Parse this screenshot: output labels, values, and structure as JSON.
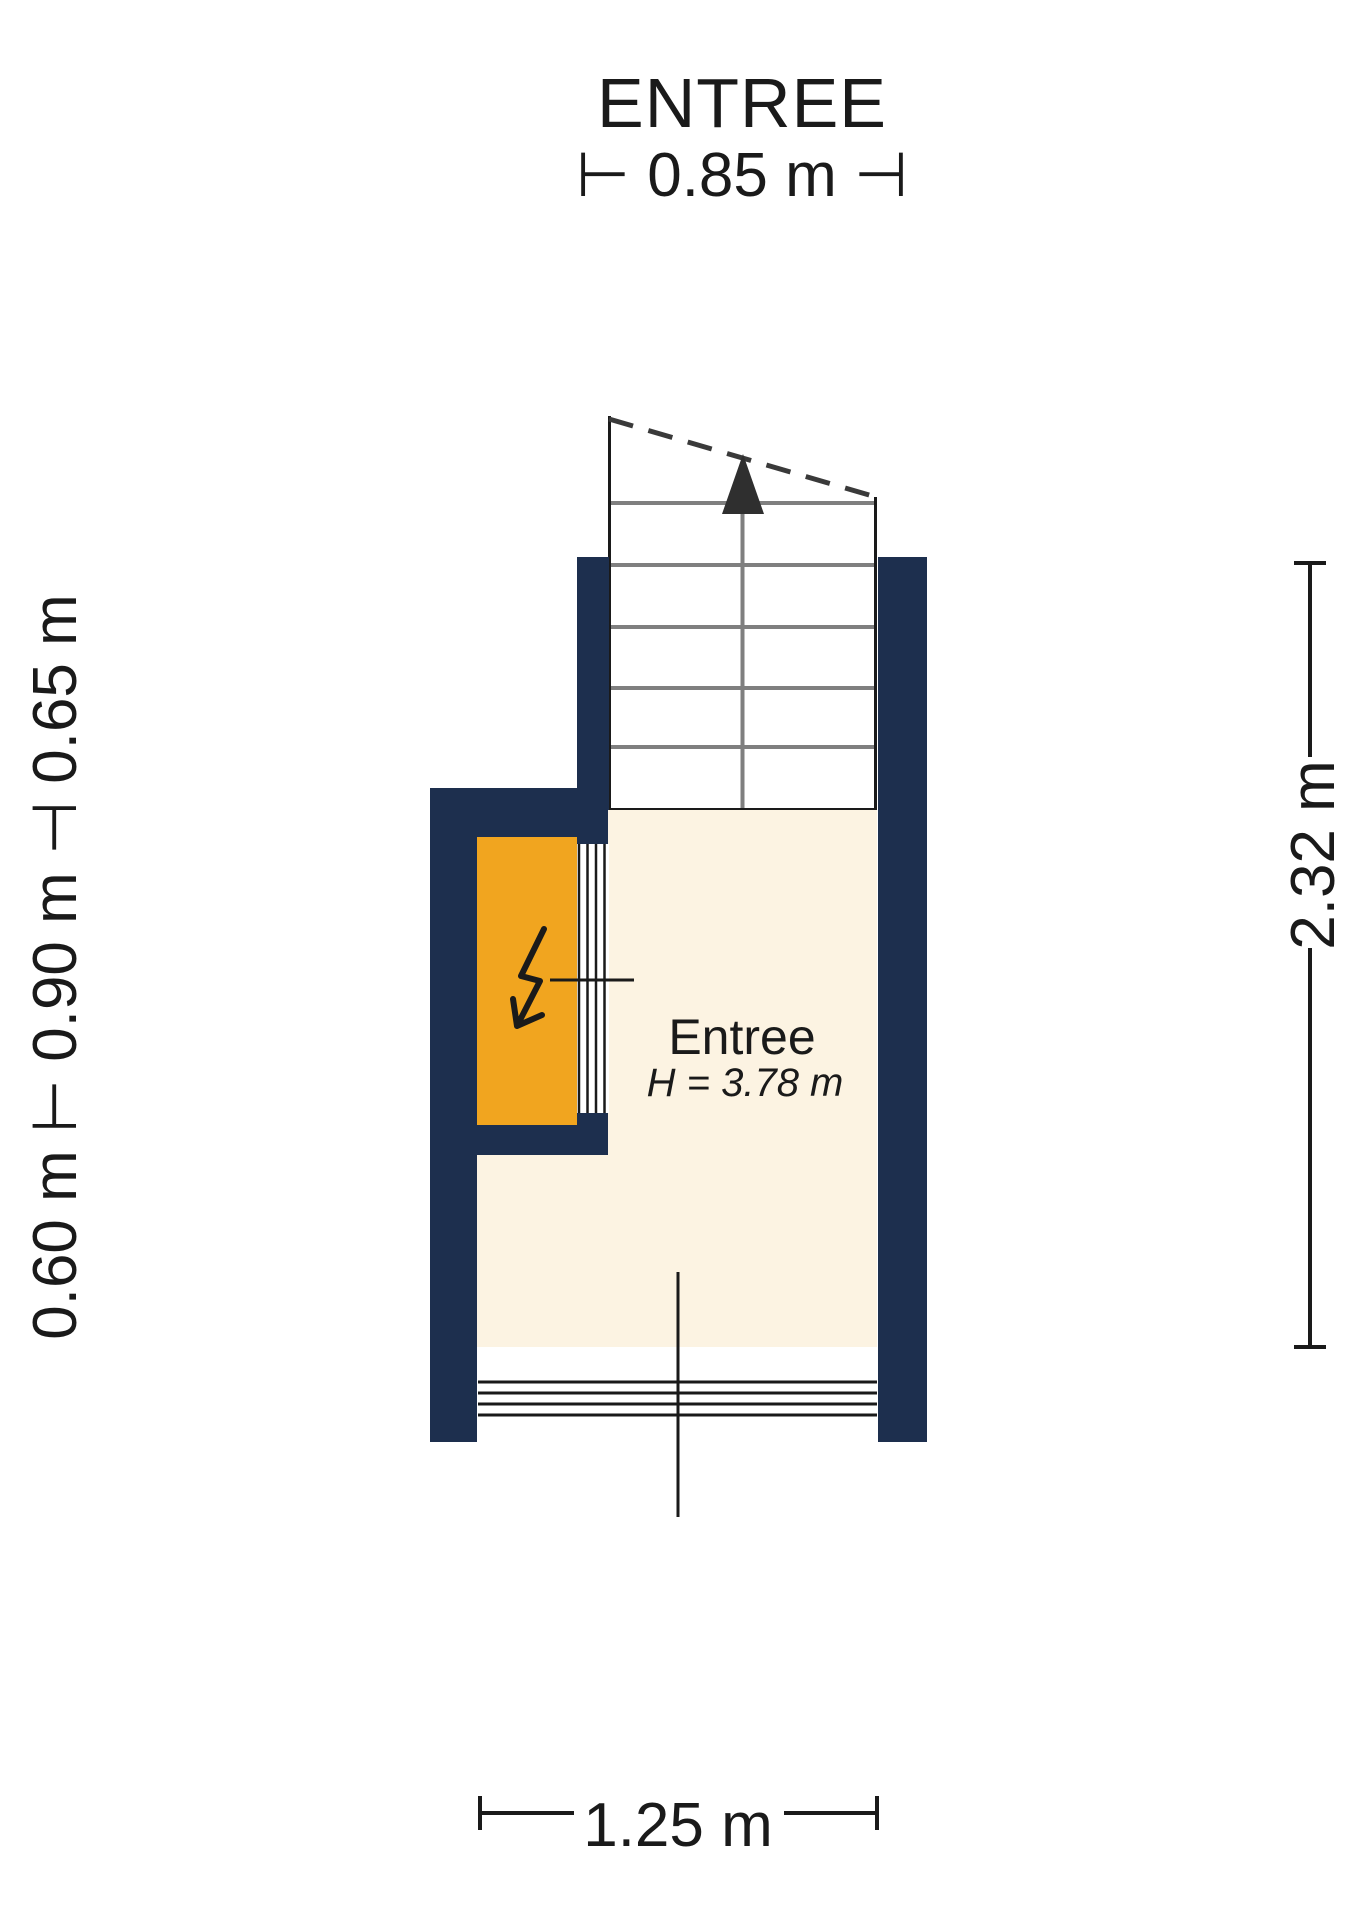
{
  "plan": {
    "title": "ENTREE",
    "room": {
      "name": "Entree",
      "height_label": "H = 3.78 m"
    },
    "dimensions": {
      "top_label": "⊢ 0.85 m ⊣",
      "left_label": "0.60 m ⊢ 0.90 m ⊣ 0.65 m",
      "right_label": "2.32 m",
      "bottom_label": "1.25 m"
    },
    "colors": {
      "wall": "#1d2f4e",
      "floor": "#fcf3e2",
      "closet": "#f1a51f",
      "stair_line": "#7f7f7f",
      "outline": "#1a1a1a",
      "background": "#ffffff"
    }
  }
}
